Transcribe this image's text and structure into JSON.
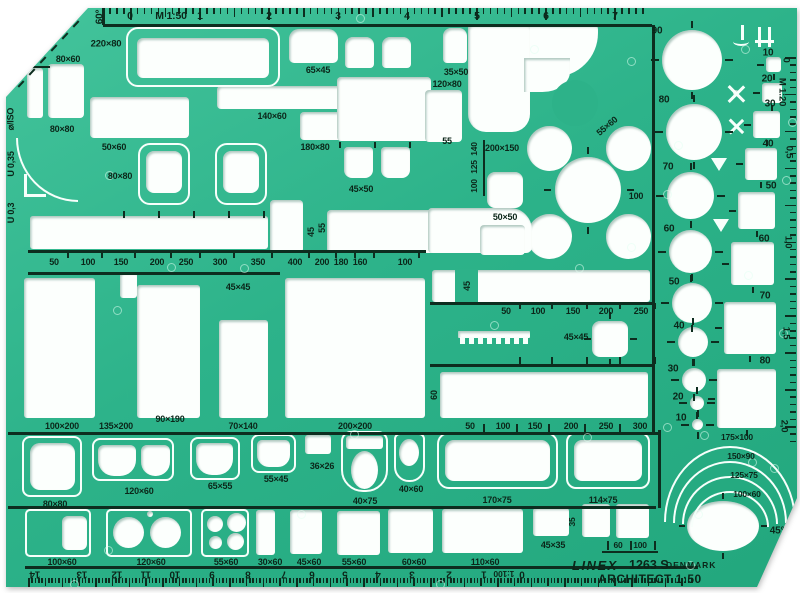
{
  "meta": {
    "brand": "LINEX",
    "model": "1263 S",
    "country": "DENMARK",
    "product": "ARCHITECT 1:50"
  },
  "colors": {
    "body_green": "#2db38a",
    "ink": "#0b2619",
    "cutout": "#fcfffd"
  },
  "labels": [
    [
      "0",
      130,
      16,
      0,
      10.5
    ],
    [
      "M 1:50",
      171,
      16,
      0,
      10.5
    ],
    [
      "1",
      200,
      16,
      0,
      10.5
    ],
    [
      "2",
      269,
      16,
      0,
      10.5
    ],
    [
      "3",
      338,
      16,
      0,
      10.5
    ],
    [
      "4",
      407,
      16,
      0,
      10.5
    ],
    [
      "5",
      477,
      16,
      0,
      10.5
    ],
    [
      "6",
      546,
      16,
      0,
      10.5
    ],
    [
      "7",
      615,
      16,
      0,
      10.5
    ],
    [
      "60°",
      100,
      17,
      -90,
      10
    ],
    [
      "30°",
      37,
      57,
      0,
      11
    ],
    [
      "220×80",
      106,
      44,
      0,
      9.5
    ],
    [
      "80×60",
      68,
      59
    ],
    [
      "80×80",
      62,
      129
    ],
    [
      "50×60",
      114,
      147
    ],
    [
      "80×80",
      120,
      176
    ],
    [
      "140×60",
      272,
      116
    ],
    [
      "65×45",
      318,
      70
    ],
    [
      "35×50",
      456,
      72
    ],
    [
      "120×80",
      447,
      84
    ],
    [
      "55",
      447,
      141
    ],
    [
      "200×150",
      502,
      148
    ],
    [
      "180×80",
      315,
      147
    ],
    [
      "45×50",
      361,
      189
    ],
    [
      "55×60",
      607,
      126,
      -40
    ],
    [
      "100",
      636,
      196
    ],
    [
      "50×50",
      505,
      217
    ],
    [
      "140",
      474,
      149,
      -90,
      8.5
    ],
    [
      "125",
      474,
      167,
      -90,
      8.5
    ],
    [
      "100",
      474,
      186,
      -90,
      8.5
    ],
    [
      "45",
      311,
      232,
      -90,
      9
    ],
    [
      "55",
      322,
      228,
      -90,
      9
    ],
    [
      "50",
      54,
      262
    ],
    [
      "100",
      88,
      262
    ],
    [
      "150",
      121,
      262
    ],
    [
      "200",
      157,
      262
    ],
    [
      "250",
      186,
      262
    ],
    [
      "300",
      220,
      262
    ],
    [
      "350",
      258,
      262
    ],
    [
      "400",
      295,
      262
    ],
    [
      "200",
      322,
      262
    ],
    [
      "180",
      341,
      262
    ],
    [
      "160",
      360,
      262
    ],
    [
      "100",
      405,
      262
    ],
    [
      "45×45",
      238,
      287
    ],
    [
      "45",
      467,
      286,
      -90,
      9
    ],
    [
      "50",
      506,
      311
    ],
    [
      "100",
      538,
      311
    ],
    [
      "150",
      573,
      311
    ],
    [
      "200",
      606,
      311
    ],
    [
      "250",
      641,
      311
    ],
    [
      "45×45",
      576,
      337
    ],
    [
      "60",
      434,
      395,
      -90,
      9
    ],
    [
      "90",
      657,
      31,
      0,
      10
    ],
    [
      "80",
      664,
      100,
      0,
      10
    ],
    [
      "70",
      668,
      167,
      0,
      10
    ],
    [
      "60",
      669,
      229,
      0,
      10
    ],
    [
      "50",
      674,
      282,
      0,
      10
    ],
    [
      "40",
      679,
      326,
      0,
      10
    ],
    [
      "30",
      673,
      369,
      0,
      10
    ],
    [
      "20",
      678,
      397,
      0,
      10
    ],
    [
      "10",
      681,
      418,
      0,
      10
    ],
    [
      "10",
      768,
      53,
      0,
      10
    ],
    [
      "20",
      767,
      79,
      0,
      10
    ],
    [
      "30",
      770,
      104,
      0,
      10
    ],
    [
      "40",
      768,
      144,
      0,
      10
    ],
    [
      "50",
      771,
      186,
      0,
      10
    ],
    [
      "60",
      764,
      239,
      0,
      10
    ],
    [
      "70",
      765,
      296,
      0,
      10
    ],
    [
      "80",
      765,
      361,
      0,
      10
    ],
    [
      "0",
      786,
      60,
      90,
      9.5
    ],
    [
      "M 1:20",
      782,
      92,
      90,
      9.5
    ],
    [
      "0,5",
      789,
      152,
      90,
      9.5
    ],
    [
      "1,0",
      788,
      242,
      90,
      9.5
    ],
    [
      "1,5",
      786,
      333,
      90,
      9.5
    ],
    [
      "2,0",
      784,
      426,
      90,
      9.5
    ],
    [
      "50",
      470,
      426
    ],
    [
      "100",
      503,
      426
    ],
    [
      "150",
      535,
      426
    ],
    [
      "200",
      571,
      426
    ],
    [
      "250",
      606,
      426
    ],
    [
      "300",
      640,
      426
    ],
    [
      "100×200",
      62,
      426
    ],
    [
      "135×200",
      116,
      426
    ],
    [
      "90×190",
      170,
      419
    ],
    [
      "70×140",
      243,
      426
    ],
    [
      "200×200",
      355,
      426
    ],
    [
      "175×100",
      737,
      437,
      0,
      8.5
    ],
    [
      "150×90",
      741,
      456,
      0,
      8.5
    ],
    [
      "125×75",
      744,
      475,
      0,
      8.5
    ],
    [
      "100×60",
      747,
      494,
      0,
      8.5
    ],
    [
      "80×80",
      55,
      504
    ],
    [
      "120×60",
      139,
      491
    ],
    [
      "65×55",
      220,
      486
    ],
    [
      "55×45",
      276,
      479
    ],
    [
      "36×26",
      322,
      466
    ],
    [
      "40×75",
      365,
      501
    ],
    [
      "40×60",
      411,
      489
    ],
    [
      "170×75",
      497,
      500
    ],
    [
      "114×75",
      603,
      500
    ],
    [
      "100×60",
      62,
      562
    ],
    [
      "120×60",
      151,
      562
    ],
    [
      "55×60",
      226,
      562
    ],
    [
      "30×60",
      270,
      562
    ],
    [
      "45×60",
      309,
      562
    ],
    [
      "55×60",
      354,
      562
    ],
    [
      "60×60",
      414,
      562
    ],
    [
      "110×60",
      485,
      562
    ],
    [
      "45×35",
      553,
      545
    ],
    [
      "35",
      572,
      522,
      -90,
      8.5
    ],
    [
      "60",
      618,
      545,
      0,
      8.5
    ],
    [
      "100",
      640,
      545,
      0,
      8.5
    ],
    [
      "45°",
      777,
      531,
      0,
      10
    ],
    [
      "14",
      35,
      574,
      180,
      10
    ],
    [
      "13",
      82,
      574,
      180,
      10
    ],
    [
      "12",
      117,
      574,
      180,
      10
    ],
    [
      "11",
      146,
      574,
      180,
      10
    ],
    [
      "10",
      175,
      574,
      180,
      10
    ],
    [
      "9",
      212,
      574,
      180,
      10
    ],
    [
      "8",
      248,
      574,
      180,
      10
    ],
    [
      "7",
      284,
      574,
      180,
      10
    ],
    [
      "6",
      312,
      574,
      180,
      10
    ],
    [
      "5",
      345,
      574,
      180,
      10
    ],
    [
      "4",
      378,
      574,
      180,
      10
    ],
    [
      "3",
      412,
      574,
      180,
      10
    ],
    [
      "2",
      449,
      574,
      180,
      10
    ],
    [
      "1",
      484,
      574,
      180,
      10
    ],
    [
      "1:100",
      504,
      574,
      180,
      8.5
    ],
    [
      "0",
      522,
      574,
      180,
      10
    ],
    [
      "U 0,3",
      11,
      213,
      -90,
      9
    ],
    [
      "U 0,35",
      11,
      164,
      -90,
      9
    ],
    [
      "⌀/ISO",
      11,
      119,
      -90,
      9
    ]
  ]
}
